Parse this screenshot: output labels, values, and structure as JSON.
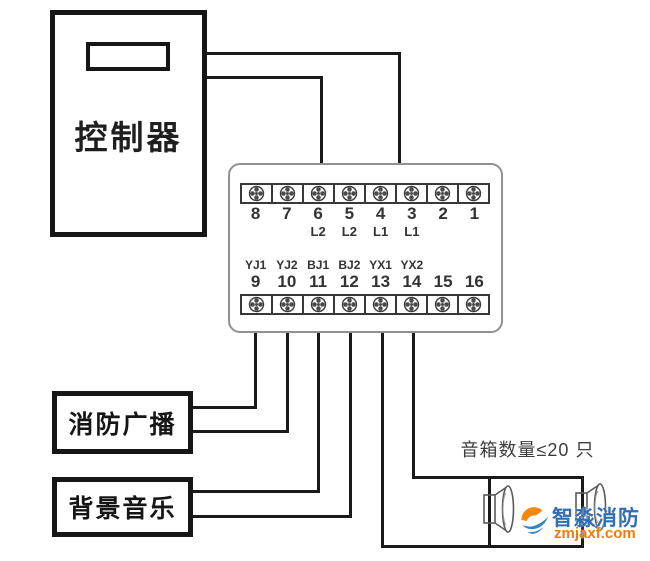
{
  "controller": {
    "label": "控制器"
  },
  "terminal_block": {
    "top_numbers": [
      "8",
      "7",
      "6",
      "5",
      "4",
      "3",
      "2",
      "1"
    ],
    "top_signal_labels": [
      "",
      "",
      "L2",
      "L2",
      "L1",
      "L1",
      "",
      ""
    ],
    "bottom_signal_labels": [
      "YJ1",
      "YJ2",
      "BJ1",
      "BJ2",
      "YX1",
      "YX2",
      "",
      ""
    ],
    "bottom_numbers": [
      "9",
      "10",
      "11",
      "12",
      "13",
      "14",
      "15",
      "16"
    ]
  },
  "devices": {
    "fire_broadcast": {
      "label": "消防广播"
    },
    "background_music": {
      "label": "背景音乐"
    }
  },
  "annotations": {
    "speaker_limit": "音箱数量≤20 只"
  },
  "watermark": {
    "brand": "智淼消防",
    "site": "zmjaxf.com"
  },
  "colors": {
    "wire": "#1a1a1a",
    "block_border": "#909090",
    "watermark_blue": "#2f6eb5",
    "watermark_orange": "#f07d00"
  }
}
